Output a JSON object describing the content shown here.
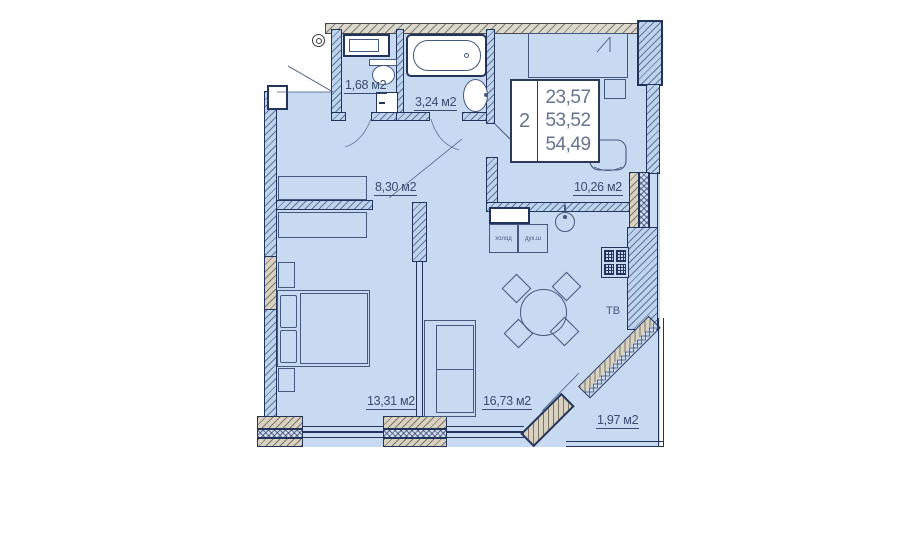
{
  "floorplan": {
    "rooms": [
      {
        "name": "wc",
        "area": "1,68 м2"
      },
      {
        "name": "bathroom",
        "area": "3,24 м2"
      },
      {
        "name": "hallway",
        "area": "8,30 м2"
      },
      {
        "name": "bedroom",
        "area": "10,26 м2"
      },
      {
        "name": "bedroom-2",
        "area": "13,31 м2"
      },
      {
        "name": "living-kitchen",
        "area": "16,73 м2"
      },
      {
        "name": "balcony",
        "area": "1,97 м2"
      }
    ],
    "info_box": {
      "rooms_count": "2",
      "values": [
        "23,57",
        "53,52",
        "54,49"
      ]
    },
    "appliances": {
      "fridge": "холод",
      "oven": "дух.ш",
      "tv": "ТВ"
    },
    "colors": {
      "floor": "#c8daf1",
      "line": "#23345c",
      "wall_accent": "#d9d2c2"
    }
  }
}
